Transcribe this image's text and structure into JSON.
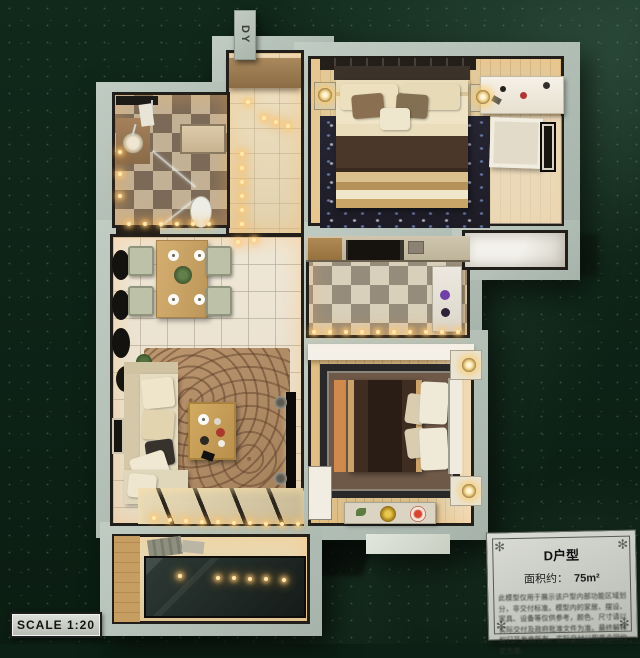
{
  "labels": {
    "unit_tag": "DY",
    "scale": "SCALE 1:20"
  },
  "placard": {
    "title": "D户型",
    "area_label": "面积约：",
    "area_value": "75m²",
    "disclaimer": "此模型仅用于展示该户型内部功能区域划分，非交付标准。模型内的家居、摆设、家具、设备等仅供参考，颜色、尺寸请以实际交付及政府批准文件为准。最终解释权归开发商所有，实际交付以购房合同约定为准。",
    "corner_glyph": "✻"
  },
  "palette": {
    "felt_green": "#0c2015",
    "wall_sage": "#b3c0b7",
    "wall_outline": "#221f1b",
    "warm_glow": "#ffd98a",
    "wood_tan": "#d8bc8e",
    "placard_bg": "#d3d6cf"
  }
}
